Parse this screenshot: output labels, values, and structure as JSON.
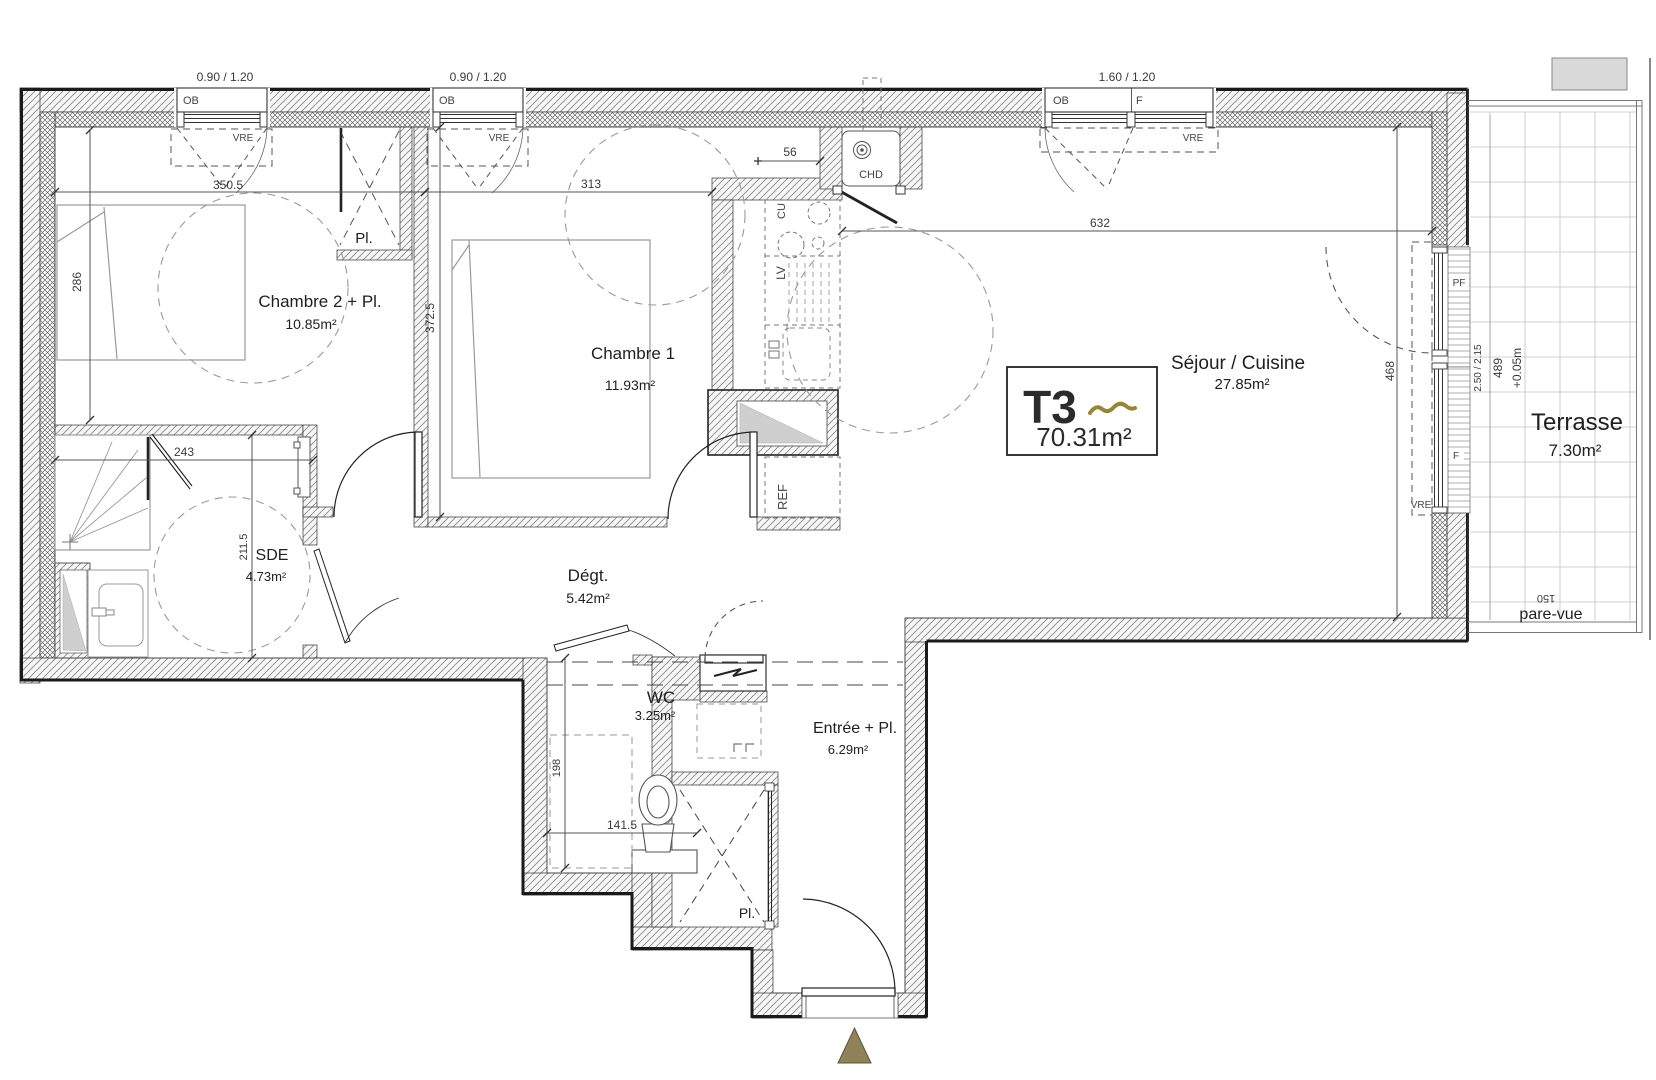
{
  "plan": {
    "unit_label": "T3",
    "unit_area": "70.31m²",
    "rooms": {
      "chambre2": {
        "name": "Chambre 2 + Pl.",
        "area": "10.85m²"
      },
      "chambre1": {
        "name": "Chambre 1",
        "area": "11.93m²"
      },
      "sejour_cuisine": {
        "name": "Séjour / Cuisine",
        "area": "27.85m²"
      },
      "sde": {
        "name": "SDE",
        "area": "4.73m²"
      },
      "degagement": {
        "name": "Dégt.",
        "area": "5.42m²"
      },
      "wc": {
        "name": "WC",
        "area": "3.25m²"
      },
      "entree": {
        "name": "Entrée + Pl.",
        "area": "6.29m²"
      },
      "terrasse": {
        "name": "Terrasse",
        "area": "7.30m²"
      }
    },
    "closets": {
      "chambre2": "Pl.",
      "entree": "Pl."
    },
    "windows": {
      "w1_size": "0.90 / 1.20",
      "w1_type": "OB",
      "w1_shutter": "VRE",
      "w2_size": "0.90 / 1.20",
      "w2_type": "OB",
      "w2_shutter": "VRE",
      "w3_size": "1.60 / 1.20",
      "w3_type_left": "OB",
      "w3_type_right": "F",
      "w3_shutter": "VRE",
      "bay_upper": "PF",
      "bay_lower": "F",
      "bay_size": "2.50 / 2.15",
      "bay_shutter": "VRE"
    },
    "equipment": {
      "water_heater": "CHD",
      "cooktop": "CU",
      "dishwasher": "LV",
      "fridge": "REF"
    },
    "terrace": {
      "level": "+0.05m",
      "screen": "pare-vue",
      "screen_height": "150"
    },
    "dims": {
      "d350_5": "350.5",
      "d286": "286",
      "d313": "313",
      "d372_5": "372.5",
      "d56": "56",
      "d632": "632",
      "d468": "468",
      "d489": "489",
      "d243": "243",
      "d211_5": "211.5",
      "d198": "198",
      "d141_5": "141.5"
    },
    "colors": {
      "accent_gold": "#9a8430",
      "arrow_fill": "#8f8158",
      "arrow_stroke": "#5f5535"
    }
  }
}
